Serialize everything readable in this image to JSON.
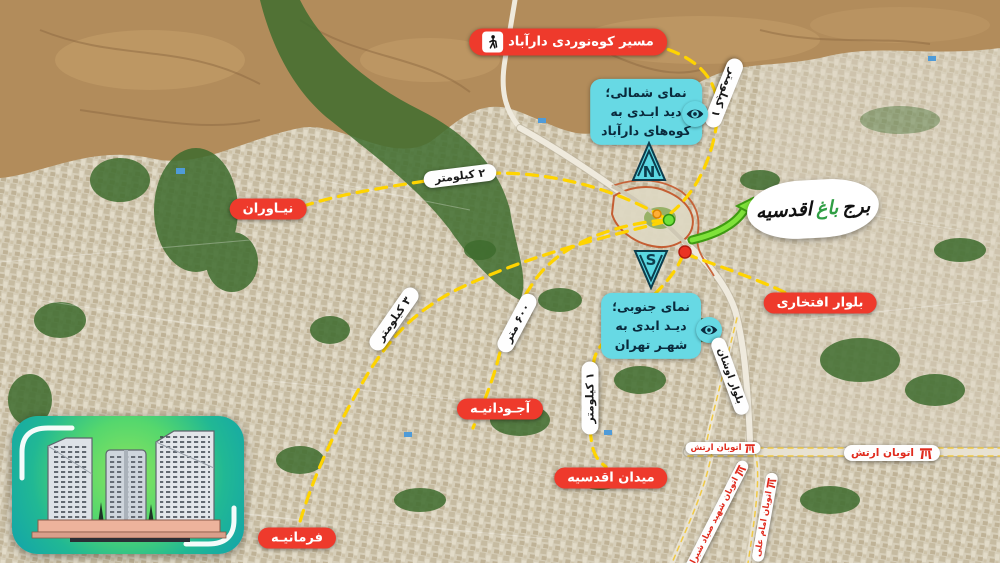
{
  "colors": {
    "label_red": "#ee3a2c",
    "cyan": "#67d9e4",
    "navy_text": "#0a2a3c",
    "route_yellow": "#ffd400",
    "arrow_green": "#7fe23a",
    "logo_green": "#2f9e44"
  },
  "logo": {
    "part1": "برج",
    "part2": "باغ",
    "part3": "اقدسیه"
  },
  "callouts": {
    "mountain_route": "مسیر کوه‌نوردی دارآباد",
    "north_view": [
      "نمای شمالی؛",
      "دید ابـدی به",
      "کوه‌های دارآباد"
    ],
    "south_view": [
      "نمای جنوبی؛",
      "دیـد ابدی به",
      "شهـر تهران"
    ],
    "compass_north": "N",
    "compass_south": "S"
  },
  "places": {
    "niavaran": "نیـاوران",
    "farmanieh": "فرمانیـه",
    "ajoudanieh": "آجـودانیـه",
    "aghdasieh_square": "میدان اقدسیه",
    "eftekhari_blvd": "بلوار افتخاری",
    "oshan_blvd": "بلوار اوشان",
    "artesh_hwy": "اتوبان ارتش",
    "sayyad_hwy": "اتوبان شهید صیاد شیرازی",
    "imam_ali_hwy": "اتوبان امام علی"
  },
  "distances": {
    "km1_top": "۱ کیلومتر",
    "km2": "۲ کیلومتر",
    "km3": "۳ کیلومتر",
    "m600": "۶۰۰ متر",
    "km1_bottom": "۱ کیلومتر"
  }
}
